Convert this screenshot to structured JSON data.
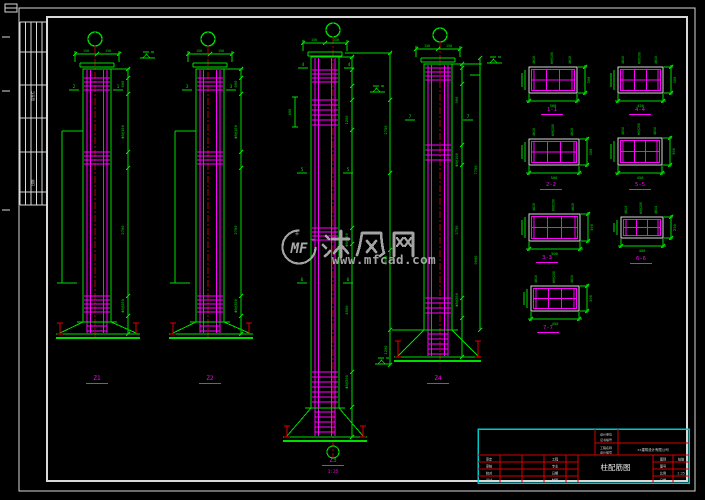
{
  "watermark": {
    "logo_text": "MF",
    "site_name": "沐风网",
    "site_url": "www.mfcad.com"
  },
  "sidebar": {
    "labels": [
      "会签栏",
      "日期"
    ]
  },
  "columns": [
    {
      "label": "Z1",
      "cuts": [
        "2",
        "1"
      ],
      "top_dims": [
        "150",
        "150"
      ],
      "side_dims": [
        "600",
        "Φ8@100",
        "2700",
        "Φ8@200"
      ]
    },
    {
      "label": "Z2",
      "cuts": [
        "3",
        "3"
      ],
      "top_dims": [
        "150",
        "150"
      ],
      "side_dims": [
        "600",
        "Φ8@100",
        "2700",
        "Φ8@200"
      ]
    },
    {
      "label": "Z3",
      "scale": "1:25",
      "bracket_dim": "600",
      "cuts": [
        "4",
        "4",
        "5",
        "5",
        "6",
        "6"
      ],
      "top_dims": [
        "150",
        "150"
      ],
      "side_dims": [
        "1200",
        "Φ8@100",
        "4500",
        "Φ8@200"
      ]
    },
    {
      "label": "Z4",
      "cuts": [
        "7",
        "7"
      ],
      "top_dims": [
        "150",
        "150"
      ],
      "side_dims": [
        "900",
        "Φ8@100",
        "2750",
        "Φ8@200"
      ]
    }
  ],
  "shared_dims": {
    "mid_chain": [
      "2750",
      "6000",
      "1200"
    ],
    "right_chain": [
      "7750",
      "9000"
    ]
  },
  "sections": [
    {
      "label": "1-1",
      "width": "500",
      "height": "300",
      "callouts": [
        "4Φ18",
        "Φ8@100",
        "4Φ18"
      ]
    },
    {
      "label": "4-4",
      "width": "450",
      "height": "300",
      "callouts": [
        "4Φ16",
        "Φ8@100",
        "4Φ16"
      ]
    },
    {
      "label": "2-2",
      "width": "500",
      "height": "300",
      "callouts": [
        "4Φ18",
        "Φ8@200",
        "4Φ18"
      ]
    },
    {
      "label": "5-5",
      "width": "450",
      "height": "300",
      "callouts": [
        "4Φ16",
        "Φ8@200",
        "4Φ16"
      ]
    },
    {
      "label": "3-3",
      "width": "500",
      "height": "300",
      "callouts": [
        "4Φ18",
        "Φ8@200",
        "4Φ18"
      ]
    },
    {
      "label": "6-6",
      "width": "400",
      "height": "250",
      "callouts": [
        "4Φ14",
        "Φ8@200",
        "4Φ14"
      ]
    },
    {
      "label": "7-7",
      "width": "450",
      "height": "300",
      "callouts": [
        "4Φ16",
        "Φ8@200",
        "4Φ16"
      ]
    }
  ],
  "title_block": {
    "stamp_labels": [
      "设计单位",
      "证书编号",
      "工程名称",
      "设计编号"
    ],
    "company": "××建筑设计有限公司",
    "left_labels": [
      "审定",
      "审核",
      "校对",
      "设计"
    ],
    "mid_labels": [
      "工程",
      "专业",
      "日期",
      "制图"
    ],
    "drawing_name": "柱配筋图",
    "right_labels": [
      "图别",
      "图号",
      "比例",
      "日期"
    ],
    "right_values": [
      "结施",
      "",
      "1:25",
      ""
    ]
  }
}
